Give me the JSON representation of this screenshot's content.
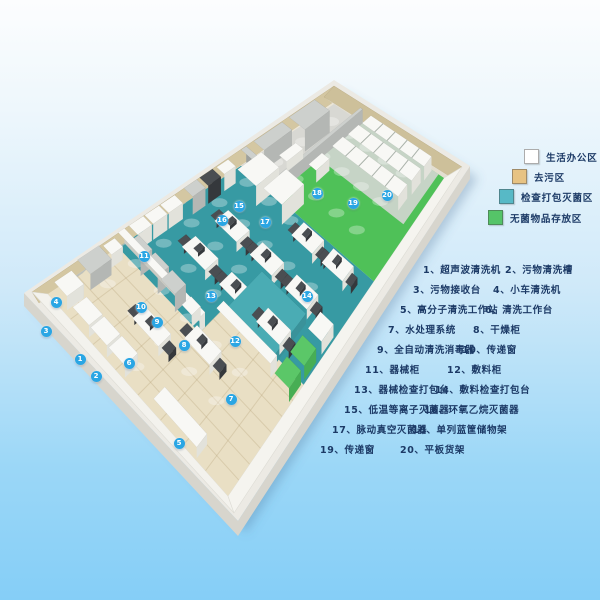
{
  "legend": {
    "items": [
      {
        "label": "生活办公区",
        "swatch_color": "#ffffff",
        "x": 524,
        "y": 149
      },
      {
        "label": "去污区",
        "swatch_color": "#e7c383",
        "x": 512,
        "y": 169
      },
      {
        "label": "检查打包灭菌区",
        "swatch_color": "#57b9c6",
        "x": 499,
        "y": 189
      },
      {
        "label": "无菌物品存放区",
        "swatch_color": "#55c468",
        "x": 488,
        "y": 210
      }
    ]
  },
  "equipment_list": {
    "num_separator": "、",
    "items": [
      {
        "num": "1",
        "name": "超声波清洗机",
        "x": 423,
        "y": 262
      },
      {
        "num": "2",
        "name": "污物清洗槽",
        "x": 505,
        "y": 262
      },
      {
        "num": "3",
        "name": "污物接收台",
        "x": 413,
        "y": 282
      },
      {
        "num": "4",
        "name": "小车清洗机",
        "x": 493,
        "y": 282
      },
      {
        "num": "5",
        "name": "高分子清洗工作站",
        "x": 400,
        "y": 302
      },
      {
        "num": "6",
        "name": "清洗工作台",
        "x": 485,
        "y": 302
      },
      {
        "num": "7",
        "name": "水处理系统",
        "x": 388,
        "y": 322
      },
      {
        "num": "8",
        "name": "干燥柜",
        "x": 473,
        "y": 322
      },
      {
        "num": "9",
        "name": "全自动清洗消毒器",
        "x": 377,
        "y": 342
      },
      {
        "num": "10",
        "name": "传递窗",
        "x": 462,
        "y": 342
      },
      {
        "num": "11",
        "name": "器械柜",
        "x": 365,
        "y": 362
      },
      {
        "num": "12",
        "name": "敷料柜",
        "x": 447,
        "y": 362
      },
      {
        "num": "13",
        "name": "器械检查打包台",
        "x": 354,
        "y": 382
      },
      {
        "num": "14",
        "name": "敷料检查打包台",
        "x": 435,
        "y": 382
      },
      {
        "num": "15",
        "name": "低温等离子灭菌器",
        "x": 344,
        "y": 402
      },
      {
        "num": "16",
        "name": "环氧乙烷灭菌器",
        "x": 424,
        "y": 402
      },
      {
        "num": "17",
        "name": "脉动真空灭菌器",
        "x": 332,
        "y": 422
      },
      {
        "num": "18",
        "name": "单列蓝筐储物架",
        "x": 412,
        "y": 422
      },
      {
        "num": "19",
        "name": "传递窗",
        "x": 320,
        "y": 442
      },
      {
        "num": "20",
        "name": "平板货架",
        "x": 400,
        "y": 442
      }
    ]
  },
  "plan_markers": [
    {
      "num": "1",
      "x": 80,
      "y": 359
    },
    {
      "num": "2",
      "x": 96,
      "y": 376
    },
    {
      "num": "3",
      "x": 46,
      "y": 331
    },
    {
      "num": "4",
      "x": 56,
      "y": 302
    },
    {
      "num": "5",
      "x": 179,
      "y": 443
    },
    {
      "num": "6",
      "x": 129,
      "y": 363
    },
    {
      "num": "7",
      "x": 231,
      "y": 399
    },
    {
      "num": "8",
      "x": 184,
      "y": 345
    },
    {
      "num": "9",
      "x": 157,
      "y": 322
    },
    {
      "num": "10",
      "x": 141,
      "y": 307
    },
    {
      "num": "11",
      "x": 144,
      "y": 256
    },
    {
      "num": "12",
      "x": 235,
      "y": 341
    },
    {
      "num": "13",
      "x": 211,
      "y": 296
    },
    {
      "num": "14",
      "x": 307,
      "y": 296
    },
    {
      "num": "15",
      "x": 239,
      "y": 206
    },
    {
      "num": "16",
      "x": 222,
      "y": 220
    },
    {
      "num": "17",
      "x": 265,
      "y": 222
    },
    {
      "num": "18",
      "x": 317,
      "y": 193
    },
    {
      "num": "19",
      "x": 353,
      "y": 203
    },
    {
      "num": "20",
      "x": 387,
      "y": 195
    }
  ],
  "colors": {
    "background_top": "#fcfdfe",
    "background_bottom": "#85cef7",
    "marker_blue": "#2aa6e4",
    "text_navy": "#1c3a66",
    "floor_decontamination": "#e9dfc4",
    "floor_inspection_packing": "#379aa3",
    "floor_sterile_storage": "#4fc158",
    "floor_office": "#d8d8d3",
    "wall_tan": "#d4c7a2",
    "wall_white": "#f3f2ed"
  }
}
